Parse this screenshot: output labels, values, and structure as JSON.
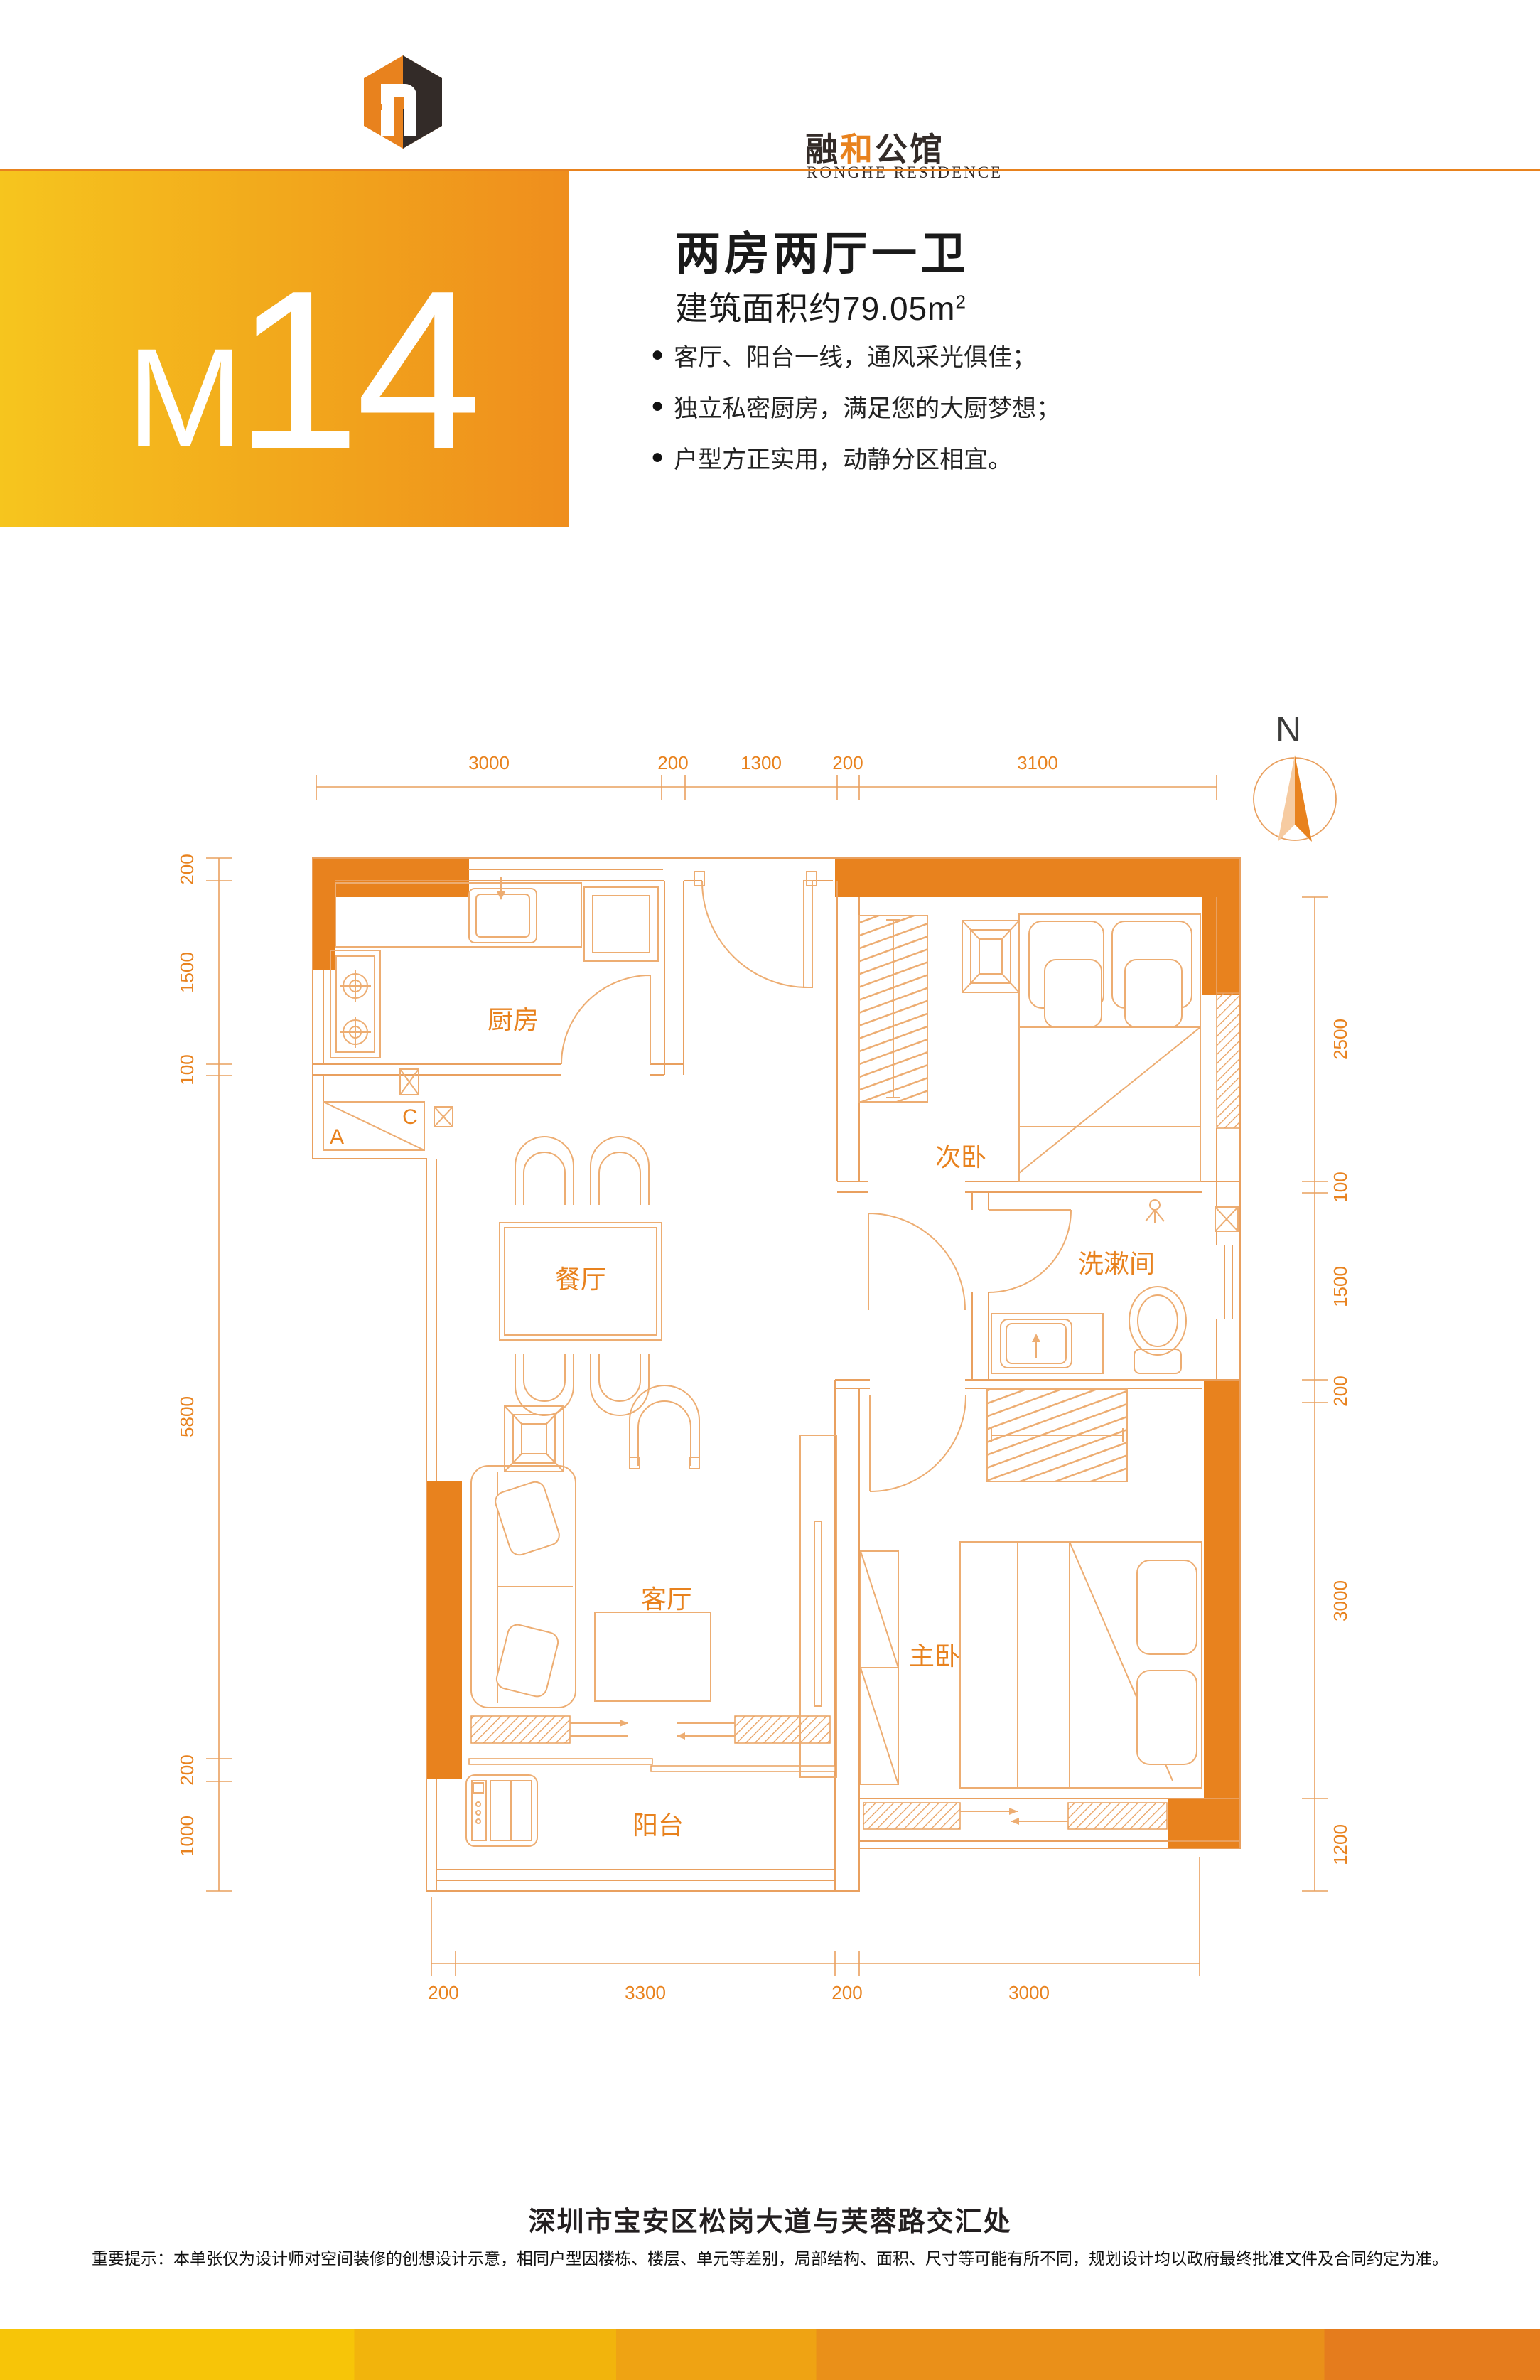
{
  "brand": {
    "logo_zh_part1": "融",
    "logo_zh_part2": "和",
    "logo_zh_part3": "公馆",
    "logo_en": "RONGHE RESIDENCE"
  },
  "banner": {
    "unit_letter": "M",
    "unit_number": "14"
  },
  "summary": {
    "title": "两房两厅一卫",
    "area_text": "建筑面积约79.05m",
    "area_sup": "2",
    "features": [
      "客厅、阳台一线，通风采光俱佳；",
      "独立私密厨房，满足您的大厨梦想；",
      "户型方正实用，动静分区相宜。"
    ]
  },
  "compass": {
    "north_label": "N"
  },
  "floorplan": {
    "room_labels": {
      "kitchen": "厨房",
      "second_bedroom": "次卧",
      "dining": "餐厅",
      "washroom": "洗漱间",
      "living": "客厅",
      "master_bedroom": "主卧",
      "balcony": "阳台"
    },
    "cabinet_labels": {
      "a": "A",
      "c": "C"
    },
    "dims": {
      "top": [
        "3000",
        "200",
        "1300",
        "200",
        "3100"
      ],
      "left": [
        "200",
        "1500",
        "100",
        "5800",
        "200",
        "1000"
      ],
      "right": [
        "2500",
        "100",
        "1500",
        "200",
        "3000",
        "1200"
      ],
      "bottom": [
        "200",
        "3300",
        "200",
        "3000"
      ]
    }
  },
  "footer": {
    "address": "深圳市宝安区松岗大道与芙蓉路交汇处",
    "disclaimer": "重要提示：本单张仅为设计师对空间装修的创想设计示意，相同户型因楼栋、楼层、单元等差别，局部结构、面积、尺寸等可能有所不同，规划设计均以政府最终批准文件及合同约定为准。"
  },
  "colors": {
    "accent_orange": "#E8821E",
    "line_orange": "#E9A05F",
    "banner_yellow": "#F6C51E",
    "banner_orange": "#EF8E1D",
    "dark_text": "#231F20"
  }
}
